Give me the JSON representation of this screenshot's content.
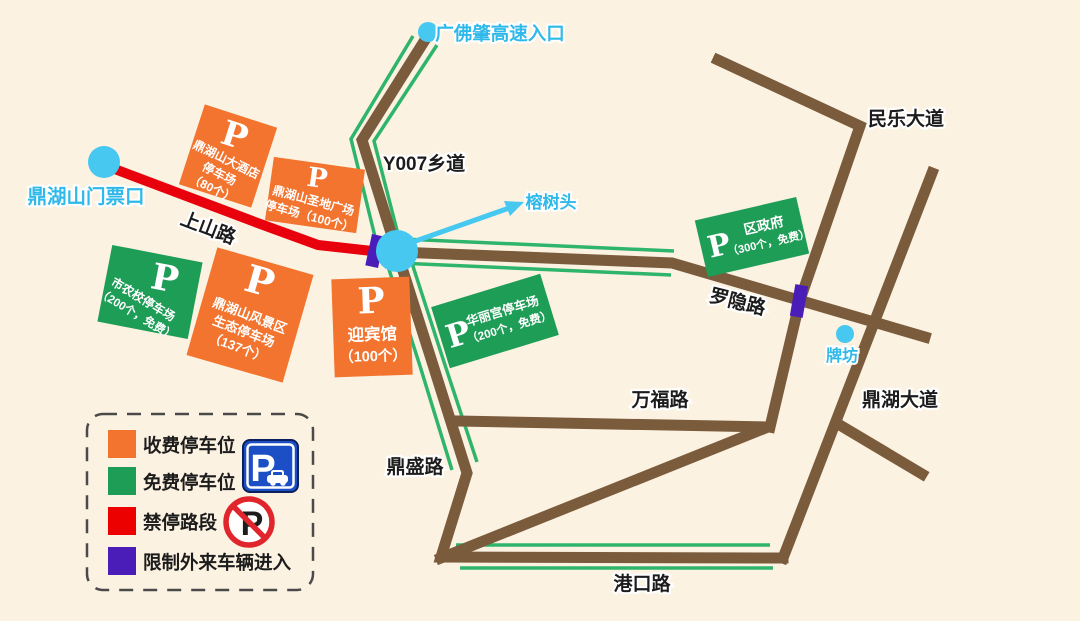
{
  "landmarks": {
    "ticket_gate": "鼎湖山门票口",
    "highway_entrance": "广佛肇高速入口",
    "banyan_tree": "榕树头",
    "archway": "牌坊"
  },
  "roads": {
    "shangshan": "上山路",
    "y007": "Y007乡道",
    "minle": "民乐大道",
    "luoyin": "罗隐路",
    "dinghu_avenue": "鼎湖大道",
    "wanfu": "万福路",
    "dingsheng": "鼎盛路",
    "gangkou": "港口路"
  },
  "parking_lots": [
    {
      "id": "dinghushan-hotel",
      "type": "paid",
      "symbol": "P",
      "lines": [
        "鼎湖山大酒店",
        "停车场",
        "（80个）"
      ]
    },
    {
      "id": "shengdi-plaza",
      "type": "paid",
      "symbol": "P",
      "lines": [
        "鼎湖山圣地广场",
        "停车场（100个）"
      ]
    },
    {
      "id": "shinongxiao",
      "type": "free",
      "symbol": "P",
      "lines": [
        "市农校停车场",
        "（200个，免费）"
      ]
    },
    {
      "id": "fengjingqu-ecological",
      "type": "paid",
      "symbol": "P",
      "lines": [
        "鼎湖山风景区",
        "生态停车场",
        "（137个）"
      ]
    },
    {
      "id": "yingbinguan",
      "type": "paid",
      "symbol": "P",
      "lines": [
        "迎宾馆",
        "（100个）"
      ]
    },
    {
      "id": "hualigong",
      "type": "free",
      "symbol": "P",
      "lines": [
        "华丽宫停车场",
        "（200个，免费）"
      ]
    },
    {
      "id": "qu-zhengfu",
      "type": "free",
      "symbol": "P",
      "lines": [
        "区政府",
        "（300个，免费）"
      ]
    }
  ],
  "legend": {
    "items": [
      {
        "label": "收费停车位",
        "color": "#F2742E"
      },
      {
        "label": "免费停车位",
        "color": "#1E9D57"
      },
      {
        "label": "禁停路段",
        "color": "#EC0000"
      },
      {
        "label": "限制外来车辆进入",
        "color": "#4A1CB8"
      }
    ],
    "parking_sign_letter": "P",
    "no_parking_letter": "P"
  },
  "colors": {
    "background": "#FCF2E2",
    "road_brown": "#7A5B3C",
    "road_green_line": "#2FB56B",
    "no_stop_red": "#E8000D",
    "restricted_purple": "#4A1CB8",
    "paid_lot_orange": "#F2742E",
    "free_lot_green": "#1E9D57",
    "landmark_cyan": "#47C8F0",
    "parking_sign_blue": "#1C4FC5"
  }
}
